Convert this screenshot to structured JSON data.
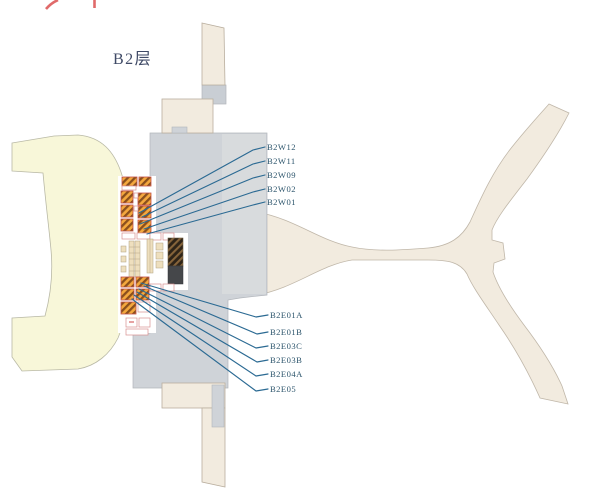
{
  "floor": {
    "label": "B2层"
  },
  "callouts": {
    "west": [
      "B2W12",
      "B2W11",
      "B2W09",
      "B2W02",
      "B2W01"
    ],
    "east": [
      "B2E01A",
      "B2E01B",
      "B2E03C",
      "B2E03B",
      "B2E04A",
      "B2E05"
    ]
  },
  "colors": {
    "background": "#ffffff",
    "cream_area": "#f8f7d9",
    "cream_outline": "#b9b9a6",
    "concourse_beige": "#f2ebdf",
    "concourse_outline": "#c0b7a9",
    "terminal_gray": "#cfd3d8",
    "terminal_gray_light": "#d9dcde",
    "terminal_outline": "#b2b6bb",
    "shaft_dark": "#45474a",
    "leader_line_blue": "#2b6a93",
    "label_text": "#2e566d",
    "floor_label_text": "#3f4a66",
    "stair_hatch_orange": "#f4a83e",
    "stair_hatch_brown": "#8a4f1d",
    "room_outline_pink": "#d88f8f",
    "cropped_mark_red": "#e06a6a"
  }
}
